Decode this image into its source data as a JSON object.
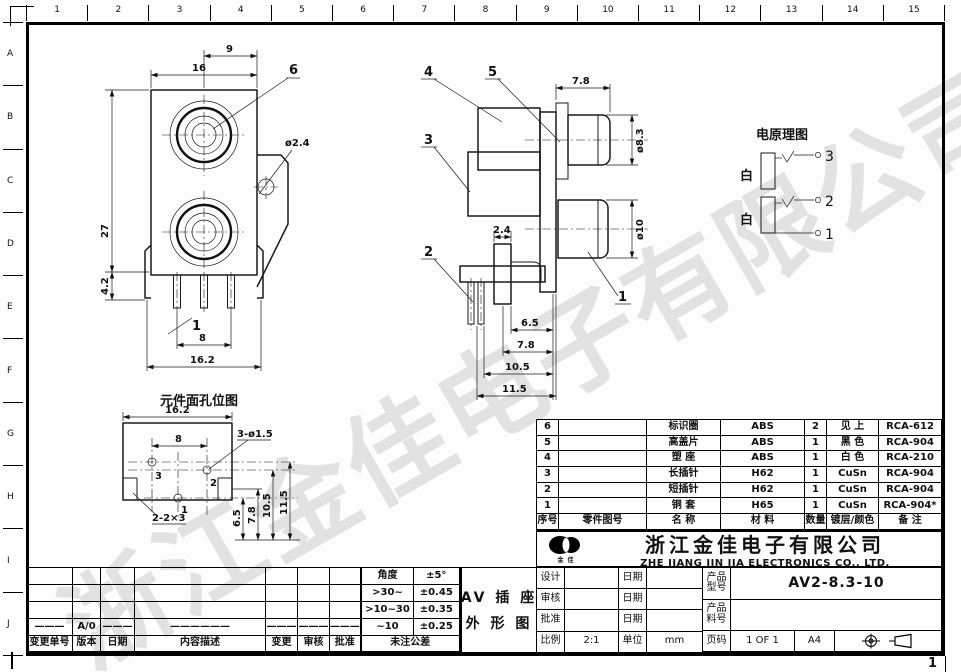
{
  "sheet": {
    "page_corner_number": "1",
    "ruler_top": [
      "1",
      "2",
      "3",
      "4",
      "5",
      "6",
      "7",
      "8",
      "9",
      "10",
      "11",
      "12",
      "13",
      "14",
      "15"
    ],
    "ruler_left": [
      "A",
      "B",
      "C",
      "D",
      "E",
      "F",
      "G",
      "H",
      "I",
      "J"
    ]
  },
  "watermark_text": "浙江金佳电子有限公司",
  "figures": {
    "front_view": {
      "dim_9": "9",
      "dim_16": "16",
      "dim_27": "27",
      "dim_4_2": "4.2",
      "dim_1": "1",
      "dim_8": "8",
      "dim_16_2": "16.2",
      "dia_2_4": "ø2.4",
      "leader_6": "6"
    },
    "side_view": {
      "dim_7_8_top": "7.8",
      "dia_8_3": "ø8.3",
      "dia_10": "ø10",
      "dim_2_4": "2.4",
      "dim_6_5": "6.5",
      "dim_7_8": "7.8",
      "dim_10_5": "10.5",
      "dim_11_5": "11.5",
      "leader_1": "1",
      "leader_2": "2",
      "leader_3": "3",
      "leader_4": "4",
      "leader_5": "5"
    },
    "hole_layout": {
      "title": "元件面孔位图",
      "dim_16_2": "16.2",
      "dim_8": "8",
      "holes_label": "3-ø1.5",
      "slots_label": "2-2×3",
      "dim_6_5": "6.5",
      "dim_7_8": "7.8",
      "dim_10_5": "10.5",
      "dim_11_5": "11.5",
      "hole_3": "3",
      "hole_2": "2",
      "hole_1": "1"
    },
    "schematic": {
      "title": "电原理图",
      "wire_label_top": "白",
      "wire_label_bottom": "白",
      "terminal_3": "3",
      "terminal_2": "2",
      "terminal_1": "1"
    }
  },
  "bom": {
    "headers": {
      "no": "序号",
      "part_no": "零件图号",
      "name": "名  称",
      "material": "材   料",
      "qty": "数量",
      "plating": "镀层/颜色",
      "remark": "备  注"
    },
    "rows": [
      {
        "no": "6",
        "part_no": "",
        "name": "标识圈",
        "material": "ABS",
        "qty": "2",
        "plating": "见 上",
        "remark": "RCA-612"
      },
      {
        "no": "5",
        "part_no": "",
        "name": "高盖片",
        "material": "ABS",
        "qty": "1",
        "plating": "黑 色",
        "remark": "RCA-904"
      },
      {
        "no": "4",
        "part_no": "",
        "name": "塑  座",
        "material": "ABS",
        "qty": "1",
        "plating": "白 色",
        "remark": "RCA-210"
      },
      {
        "no": "3",
        "part_no": "",
        "name": "长插针",
        "material": "H62",
        "qty": "1",
        "plating": "CuSn",
        "remark": "RCA-904"
      },
      {
        "no": "2",
        "part_no": "",
        "name": "短插针",
        "material": "H62",
        "qty": "1",
        "plating": "CuSn",
        "remark": "RCA-904"
      },
      {
        "no": "1",
        "part_no": "",
        "name": "铜  套",
        "material": "H65",
        "qty": "1",
        "plating": "CuSn",
        "remark": "RCA-904*"
      }
    ]
  },
  "company": {
    "logo_caption": "金 佳",
    "name_cn": "浙江金佳电子有限公司",
    "name_en": "ZHE JIANG JIN JIA ELECTRONICS CO., LTD."
  },
  "drawing_name": {
    "line1": "AV 插 座",
    "line2": "外 形 图"
  },
  "tolerance": {
    "rows": [
      {
        "range": "角度",
        "value": "±5°"
      },
      {
        "range": ">30~",
        "value": "±0.45"
      },
      {
        "range": ">10~30",
        "value": "±0.35"
      },
      {
        "range": "~10",
        "value": "±0.25"
      }
    ],
    "footer": "未注公差"
  },
  "title_block": {
    "design_label": "设计",
    "review_label": "审核",
    "approve_label": "批准",
    "date_label": "日期",
    "model_label": "产品型号",
    "model_value": "AV2-8.3-10",
    "part_no_label": "产品料号",
    "part_no_value": "",
    "scale_label": "比例",
    "scale_value": "2:1",
    "unit_label": "单位",
    "unit_value": "mm",
    "page_label": "页码",
    "page_value": "1 OF 1",
    "paper_size": "A4"
  },
  "revision": {
    "headers": [
      "变更单号",
      "版本",
      "日期",
      "内容描述",
      "变更",
      "审核",
      "批准"
    ],
    "entry": {
      "order_no": "———",
      "version": "A/0",
      "date": "———",
      "description": "——————",
      "change": "———",
      "review": "———",
      "approve": "———"
    }
  }
}
